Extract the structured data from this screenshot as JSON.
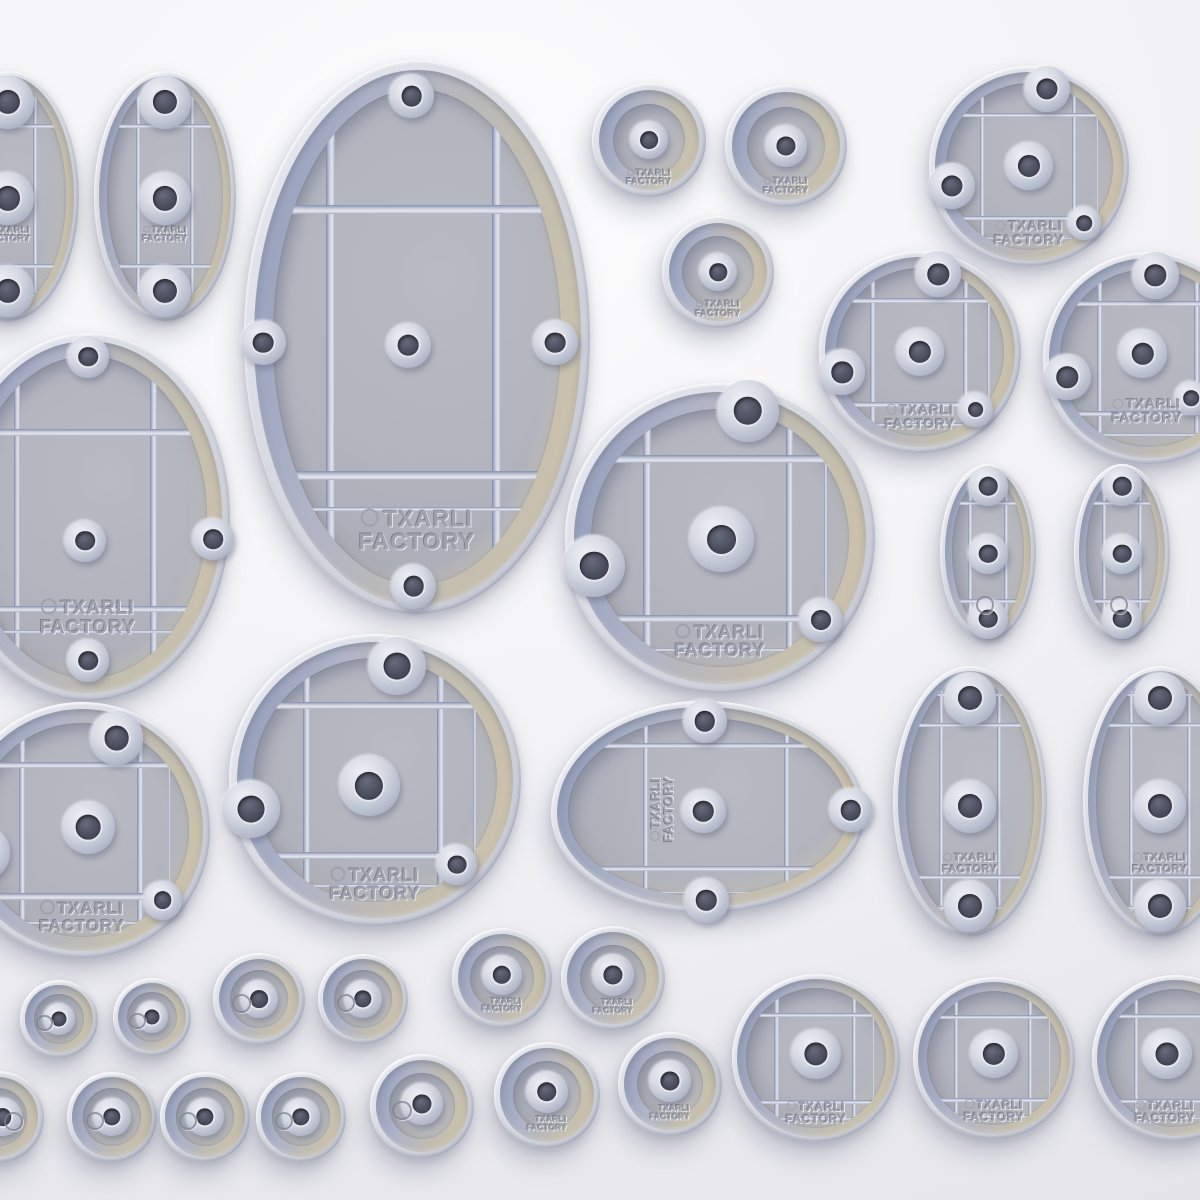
{
  "scene": {
    "description": "3D render of miniature wargame bases (underside view) in assorted oval and round sizes",
    "brand_line1": "TXARLI",
    "brand_line2": "FACTORY",
    "background": {
      "light": "#fcfcfd",
      "mid": "#f0f0f4",
      "dark": "#e0e0e6"
    },
    "palette": {
      "rim": "#d7d9e1",
      "rim_highlight": "#f2f3f7",
      "well_shadow_blue": "#909ab8",
      "well_tan": "#cdc3ab",
      "field": "#b1b3bd",
      "rib": "#c9cdda",
      "rib_shadow": "#7e88ac",
      "rib_highlight": "#e4e7ef",
      "hole_cone": "#d6dae3",
      "hole_dark": "#4a4e5d",
      "engraving": "#9fa1ad",
      "shadow": "rgba(104,110,132,0.33)"
    }
  },
  "rib_templates": {
    "circle-grid": {
      "v": [
        [
          -0.47,
          1
        ],
        [
          0.45,
          1
        ],
        [
          0.68,
          0
        ]
      ],
      "h": [
        [
          -0.51,
          1
        ],
        [
          0.52,
          1
        ],
        [
          0.72,
          0
        ]
      ]
    },
    "oval-small": {
      "v": [
        [
          -0.38,
          1
        ],
        [
          0.38,
          1
        ]
      ],
      "h": [
        [
          -0.56,
          1
        ],
        [
          0.56,
          1
        ],
        [
          -0.79,
          0
        ],
        [
          0.79,
          0
        ]
      ]
    },
    "oval-large": {
      "v": [
        [
          -0.5,
          1
        ],
        [
          0.46,
          1
        ]
      ],
      "h": [
        [
          -0.46,
          1
        ],
        [
          0.5,
          1
        ],
        [
          0.62,
          0
        ]
      ]
    },
    "egg": {
      "v": [
        [
          -0.4,
          1
        ],
        [
          0.5,
          1
        ]
      ],
      "h": [
        [
          -0.58,
          1
        ],
        [
          0.58,
          1
        ],
        [
          0.8,
          0
        ]
      ]
    }
  },
  "bases": [
    {
      "id": "oval-small-edge-left",
      "type": "oval",
      "cx": 8,
      "cy": 196,
      "rx": 71,
      "ry": 125,
      "ribs": "oval-small",
      "holes": [
        [
          0,
          -0.75,
          0.37
        ],
        [
          0,
          0.02,
          0.37
        ],
        [
          0,
          0.76,
          0.37
        ]
      ],
      "text": {
        "dy": 0.31,
        "fs": 9
      }
    },
    {
      "id": "oval-small-top",
      "type": "oval",
      "cx": 165,
      "cy": 196,
      "rx": 71,
      "ry": 125,
      "ribs": "oval-small",
      "holes": [
        [
          0,
          -0.75,
          0.37
        ],
        [
          0,
          0.02,
          0.37
        ],
        [
          0,
          0.76,
          0.37
        ]
      ],
      "text": {
        "dy": 0.31,
        "fs": 9
      }
    },
    {
      "id": "oval-xlarge-top",
      "type": "oval",
      "cx": 417,
      "cy": 337,
      "rx": 173,
      "ry": 277,
      "ribs": "oval-large",
      "holes": [
        [
          -0.03,
          -0.87,
          0.13
        ],
        [
          -0.89,
          0.02,
          0.13
        ],
        [
          -0.05,
          0.03,
          0.13
        ],
        [
          0.8,
          0.02,
          0.13
        ],
        [
          -0.02,
          0.9,
          0.13
        ]
      ],
      "text": {
        "dy": 0.7,
        "fs": 23
      }
    },
    {
      "id": "round-plain-med-1",
      "type": "plain",
      "cx": 649,
      "cy": 140,
      "r": 57,
      "holes": [
        [
          0,
          0,
          0.34
        ]
      ],
      "text": {
        "dy": 0.66,
        "fs": 9
      }
    },
    {
      "id": "round-plain-med-2",
      "type": "plain",
      "cx": 786,
      "cy": 146,
      "r": 61,
      "holes": [
        [
          0,
          0,
          0.34
        ]
      ],
      "text": {
        "dy": 0.66,
        "fs": 9
      }
    },
    {
      "id": "round-plain-med-3",
      "type": "plain",
      "cx": 718,
      "cy": 272,
      "r": 56,
      "holes": [
        [
          0,
          0,
          0.34
        ]
      ],
      "text": {
        "dy": 0.66,
        "fs": 9
      }
    },
    {
      "id": "round-grid-topright",
      "type": "circle",
      "cx": 1029,
      "cy": 166,
      "r": 100,
      "ribs": "circle-grid",
      "holes": [
        [
          0.18,
          -0.77,
          0.23
        ],
        [
          -0.77,
          0.2,
          0.23
        ],
        [
          0,
          0,
          0.24
        ],
        [
          0.55,
          0.57,
          0.17
        ]
      ],
      "text": {
        "dy": 0.67,
        "fs": 14
      }
    },
    {
      "id": "round-grid-right-a",
      "type": "circle",
      "cx": 920,
      "cy": 352,
      "r": 101,
      "ribs": "circle-grid",
      "holes": [
        [
          0.18,
          -0.77,
          0.23
        ],
        [
          -0.77,
          0.2,
          0.23
        ],
        [
          0,
          0,
          0.24
        ],
        [
          0.55,
          0.57,
          0.17
        ]
      ],
      "text": {
        "dy": 0.64,
        "fs": 14
      }
    },
    {
      "id": "round-grid-right-b-cut",
      "type": "circle",
      "cx": 1149,
      "cy": 358,
      "r": 106,
      "ribs": "circle-grid",
      "holes": [
        [
          0.06,
          -0.78,
          0.22
        ],
        [
          -0.77,
          0.18,
          0.22
        ],
        [
          -0.06,
          -0.04,
          0.23
        ],
        [
          0.4,
          0.38,
          0.16
        ]
      ],
      "text": {
        "dx": -0.02,
        "dy": 0.5,
        "fs": 14
      }
    },
    {
      "id": "oval-large-edge-left",
      "type": "oval",
      "cx": 88,
      "cy": 517,
      "rx": 142,
      "ry": 184,
      "ribs": "oval-large",
      "holes": [
        [
          0,
          -0.87,
          0.15
        ],
        [
          -0.02,
          0.13,
          0.15
        ],
        [
          0.88,
          0.12,
          0.15
        ],
        [
          0,
          0.78,
          0.15
        ]
      ],
      "text": {
        "dy": 0.55,
        "fs": 19
      }
    },
    {
      "id": "round-grid-center-large",
      "type": "circle",
      "cx": 720,
      "cy": 538,
      "r": 155,
      "ribs": "circle-grid",
      "holes": [
        [
          0.18,
          -0.82,
          0.2
        ],
        [
          -0.81,
          0.18,
          0.2
        ],
        [
          0.01,
          0.01,
          0.21
        ],
        [
          0.65,
          0.53,
          0.14
        ]
      ],
      "text": {
        "dy": 0.67,
        "fs": 18
      }
    },
    {
      "id": "oval-mini-right-a",
      "type": "oval",
      "cx": 988,
      "cy": 552,
      "rx": 48,
      "ry": 88,
      "ribs": "oval-small",
      "holes": [
        [
          0,
          -0.75,
          0.42
        ],
        [
          0,
          0.02,
          0.42
        ],
        [
          0,
          0.76,
          0.42
        ]
      ],
      "logo": {
        "dx": -0.1,
        "dy": 0.58,
        "size": 0.14
      }
    },
    {
      "id": "oval-mini-right-b",
      "type": "oval",
      "cx": 1122,
      "cy": 552,
      "rx": 48,
      "ry": 88,
      "ribs": "oval-small",
      "holes": [
        [
          0,
          -0.75,
          0.42
        ],
        [
          0,
          0.02,
          0.42
        ],
        [
          0,
          0.76,
          0.42
        ]
      ],
      "logo": {
        "dx": -0.1,
        "dy": 0.58,
        "size": 0.14
      }
    },
    {
      "id": "round-grid-left-cut",
      "type": "circle",
      "cx": 82,
      "cy": 830,
      "r": 128,
      "ribs": "circle-grid",
      "holes": [
        [
          0.27,
          -0.72,
          0.21
        ],
        [
          -0.77,
          0.18,
          0.21
        ],
        [
          0.05,
          -0.02,
          0.21
        ],
        [
          0.63,
          0.55,
          0.15
        ]
      ],
      "text": {
        "dy": 0.68,
        "fs": 17
      }
    },
    {
      "id": "round-grid-mid-large",
      "type": "circle",
      "cx": 375,
      "cy": 780,
      "r": 146,
      "ribs": "circle-grid",
      "holes": [
        [
          0.15,
          -0.78,
          0.2
        ],
        [
          -0.85,
          0.2,
          0.2
        ],
        [
          -0.04,
          0.04,
          0.21
        ],
        [
          0.56,
          0.58,
          0.14
        ]
      ],
      "text": {
        "dy": 0.72,
        "fs": 18
      }
    },
    {
      "id": "oval-egg-center",
      "type": "egg",
      "cx": 708,
      "cy": 807,
      "rx": 157,
      "ry": 106,
      "ribs": "egg",
      "holes": [
        [
          -0.02,
          -0.81,
          0.21
        ],
        [
          -0.03,
          0.04,
          0.21
        ],
        [
          0.91,
          0.03,
          0.21
        ],
        [
          -0.01,
          0.88,
          0.21
        ]
      ],
      "text": {
        "dx": -0.29,
        "dy": 0.02,
        "fs": 13,
        "rot": -90
      }
    },
    {
      "id": "oval-med-right-a",
      "type": "oval",
      "cx": 970,
      "cy": 801,
      "rx": 77,
      "ry": 135,
      "ribs": "oval-small",
      "holes": [
        [
          0,
          -0.76,
          0.34
        ],
        [
          0,
          0.04,
          0.34
        ],
        [
          0,
          0.78,
          0.34
        ]
      ],
      "text": {
        "dy": 0.47,
        "fs": 11
      }
    },
    {
      "id": "oval-med-right-b-cut",
      "type": "oval",
      "cx": 1160,
      "cy": 801,
      "rx": 77,
      "ry": 135,
      "ribs": "oval-small",
      "holes": [
        [
          0,
          -0.76,
          0.34
        ],
        [
          0,
          0.04,
          0.34
        ],
        [
          0,
          0.78,
          0.34
        ]
      ],
      "text": {
        "dy": 0.47,
        "fs": 11
      }
    },
    {
      "id": "round-mini-a1",
      "type": "plain",
      "cx": 59,
      "cy": 1019,
      "r": 39,
      "holes": [
        [
          0,
          0,
          0.42
        ]
      ],
      "logo": {
        "dx": -0.42,
        "dy": 0.05,
        "size": 0.16
      }
    },
    {
      "id": "round-mini-a2",
      "type": "plain",
      "cx": 152,
      "cy": 1017,
      "r": 39,
      "holes": [
        [
          0,
          0,
          0.42
        ]
      ],
      "logo": {
        "dx": -0.42,
        "dy": 0.05,
        "size": 0.16
      }
    },
    {
      "id": "round-mini-a3",
      "type": "plain",
      "cx": 259,
      "cy": 999,
      "r": 46,
      "holes": [
        [
          0,
          0,
          0.42
        ]
      ],
      "logo": {
        "dx": -0.42,
        "dy": 0.05,
        "size": 0.16
      }
    },
    {
      "id": "round-mini-a4",
      "type": "plain",
      "cx": 363,
      "cy": 999,
      "r": 45,
      "holes": [
        [
          0,
          0,
          0.42
        ]
      ],
      "logo": {
        "dx": -0.42,
        "dy": 0.05,
        "size": 0.16
      }
    },
    {
      "id": "round-small-a5",
      "type": "plain",
      "cx": 502,
      "cy": 978,
      "r": 50,
      "holes": [
        [
          0,
          -0.06,
          0.4
        ]
      ],
      "text": {
        "dy": 0.55,
        "fs": 8
      }
    },
    {
      "id": "round-small-a6",
      "type": "plain",
      "cx": 613,
      "cy": 978,
      "r": 52,
      "holes": [
        [
          0,
          -0.06,
          0.4
        ]
      ],
      "text": {
        "dy": 0.55,
        "fs": 8
      }
    },
    {
      "id": "round-mini-b1-cut",
      "type": "plain",
      "cx": -2,
      "cy": 1117,
      "r": 46,
      "holes": [
        [
          0.1,
          0,
          0.42
        ]
      ],
      "logo": {
        "dx": 0.3,
        "dy": 0.05,
        "size": 0.16
      }
    },
    {
      "id": "round-mini-b2",
      "type": "plain",
      "cx": 112,
      "cy": 1117,
      "r": 45,
      "holes": [
        [
          0,
          0,
          0.42
        ]
      ],
      "logo": {
        "dx": -0.42,
        "dy": 0.05,
        "size": 0.16
      }
    },
    {
      "id": "round-mini-b3",
      "type": "plain",
      "cx": 205,
      "cy": 1117,
      "r": 45,
      "holes": [
        [
          0,
          0,
          0.42
        ]
      ],
      "logo": {
        "dx": -0.42,
        "dy": 0.05,
        "size": 0.16
      }
    },
    {
      "id": "round-mini-b4",
      "type": "plain",
      "cx": 301,
      "cy": 1117,
      "r": 45,
      "holes": [
        [
          0,
          0,
          0.42
        ]
      ],
      "logo": {
        "dx": -0.42,
        "dy": 0.05,
        "size": 0.16
      }
    },
    {
      "id": "round-small-b5",
      "type": "plain",
      "cx": 422,
      "cy": 1106,
      "r": 52,
      "holes": [
        [
          0,
          -0.04,
          0.4
        ]
      ],
      "logo": {
        "dx": -0.42,
        "dy": 0.05,
        "size": 0.15
      }
    },
    {
      "id": "round-small-b6",
      "type": "plain",
      "cx": 547,
      "cy": 1095,
      "r": 53,
      "holes": [
        [
          0,
          -0.06,
          0.4
        ]
      ],
      "text": {
        "dy": 0.55,
        "fs": 8
      }
    },
    {
      "id": "round-small-b7",
      "type": "plain",
      "cx": 670,
      "cy": 1084,
      "r": 52,
      "holes": [
        [
          0,
          -0.06,
          0.4
        ]
      ],
      "text": {
        "dy": 0.55,
        "fs": 8
      }
    },
    {
      "id": "round-grid-bottom-1",
      "type": "circle",
      "cx": 816,
      "cy": 1058,
      "r": 84,
      "ribs": "circle-grid",
      "holes": [
        [
          0,
          -0.05,
          0.3
        ]
      ],
      "text": {
        "dy": 0.65,
        "fs": 12
      }
    },
    {
      "id": "round-grid-bottom-2",
      "type": "circle",
      "cx": 994,
      "cy": 1058,
      "r": 81,
      "ribs": "circle-grid",
      "holes": [
        [
          0,
          -0.05,
          0.3
        ]
      ],
      "text": {
        "dy": 0.65,
        "fs": 12
      }
    },
    {
      "id": "round-grid-bottom-3-cut",
      "type": "circle",
      "cx": 1175,
      "cy": 1058,
      "r": 83,
      "ribs": "circle-grid",
      "holes": [
        [
          -0.1,
          -0.05,
          0.3
        ]
      ],
      "text": {
        "dx": -0.12,
        "dy": 0.65,
        "fs": 12
      }
    }
  ]
}
